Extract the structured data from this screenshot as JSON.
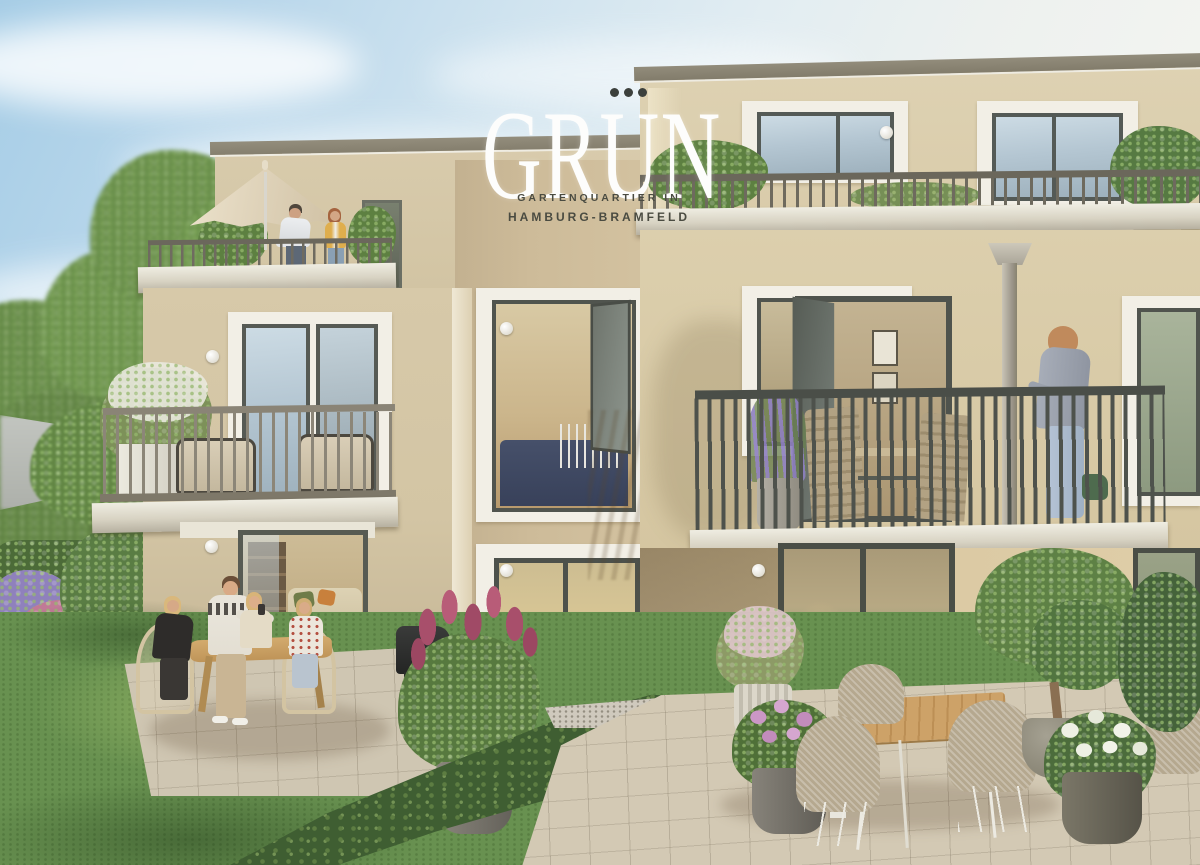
{
  "logo": {
    "title": "GRUN",
    "umlaut_dots_count": 3,
    "tagline_line1": "GARTENQUARTIER IN",
    "tagline_line2": "HAMBURG-BRAMFELD"
  },
  "palette": {
    "sky_blue": "#a6cde6",
    "sky_horizon": "#f5f5f1",
    "facade_light": "#ddd1b2",
    "facade_shadow": "#c0ae8c",
    "window_trim_white": "#f2efe6",
    "window_frame_dark": "#50544e",
    "railing_dark": "#4e524c",
    "railing_light": "#8c8678",
    "roof_fascia": "#8d8776",
    "lawn_green": "#6b9350",
    "hedge_green": "#55703f",
    "umbrella_cream": "#e0d5bd",
    "lilac_pink": "#a84f6b",
    "lavender_purple": "#8d7fc0",
    "hydrangea_pink": "#c893c4",
    "hydrangea_white": "#edeee2",
    "wood_table": "#c69a5e",
    "dog_cream": "#ece1cc",
    "logo_text": "#fdfdfc",
    "tagline_text": "#4a4b41"
  }
}
